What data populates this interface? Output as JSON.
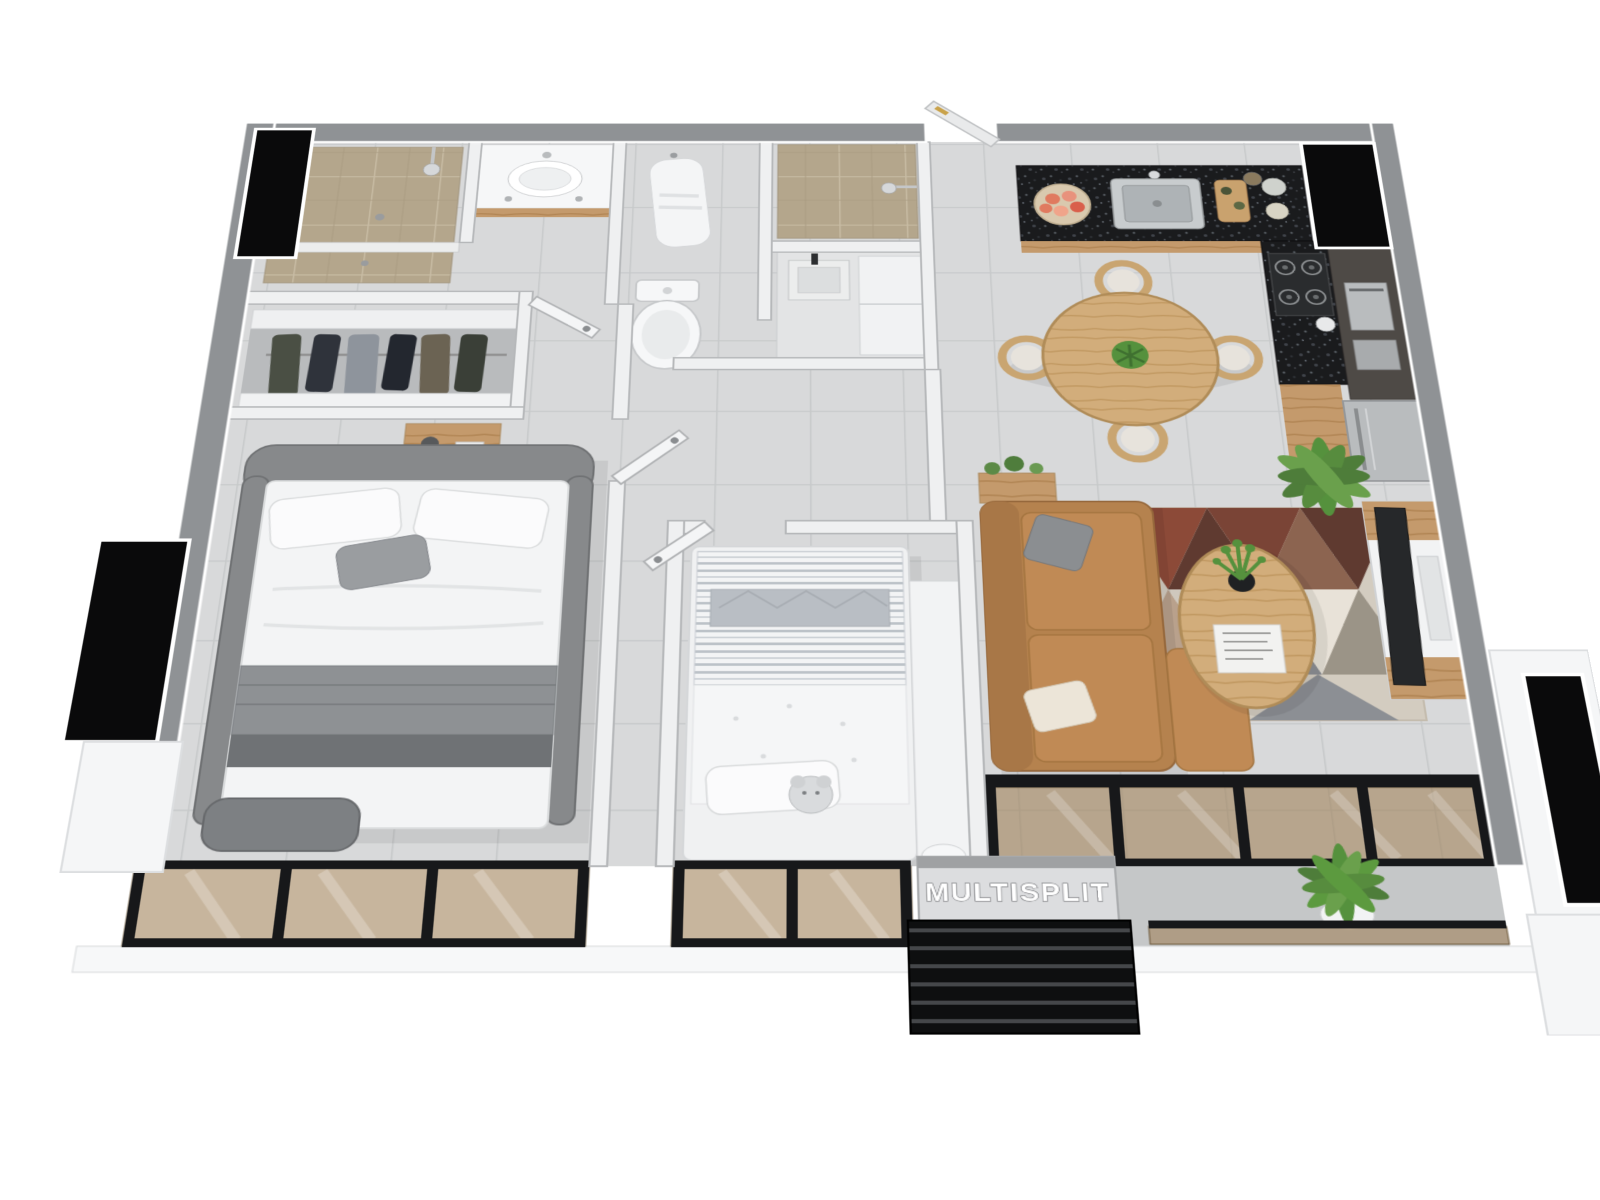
{
  "labels": {
    "multisplit": "MULTISPLIT"
  },
  "colors": {
    "wall_cap": "#8f9295",
    "interior_wall": "#eff0f1",
    "floor_tile": "#d8d9da",
    "floor_grout": "#c7c9ca",
    "tile_tan": "#b4a68c",
    "granite": "#1a1b1d",
    "wood": "#c49a6c",
    "wood_light": "#d2ad7b",
    "glass_bronze": "#9e8056",
    "black_mass": "#0a0a0b",
    "sofa_tan": "#b5824e",
    "bed_gray": "#87898b",
    "textile_runner": "#8e9194",
    "rug_terracotta": "#8c4a38",
    "rug_brown": "#5f3a30",
    "rug_gray": "#8c8f94",
    "rug_cream": "#e8e2d8",
    "plant_green": "#55913d",
    "louver_black": "#0e0f10",
    "balcony_floor": "#c5c7c8"
  }
}
